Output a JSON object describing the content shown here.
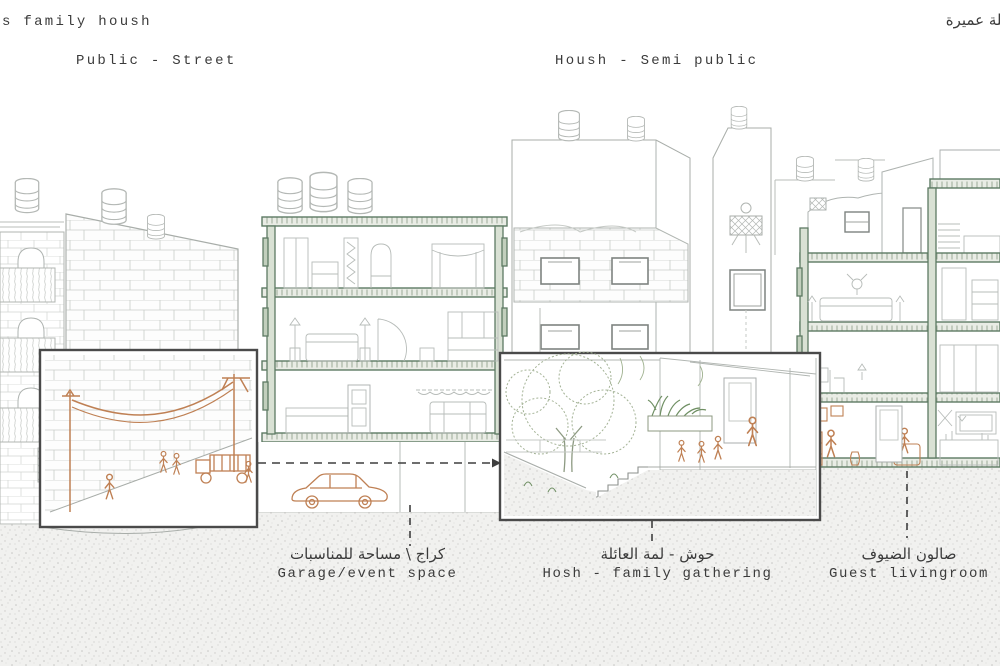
{
  "header": {
    "title_left": "s family housh",
    "title_right_ar": "نلة عميرة"
  },
  "zones": {
    "public_street": "Public - Street",
    "housh_semi_public": "Housh - Semi public"
  },
  "captions": {
    "garage": {
      "ar": "كراج \\ مساحة للمناسبات",
      "en": "Garage/event space"
    },
    "hosh": {
      "ar": "حوش - لمة العائلة",
      "en": "Hosh - family gathering"
    },
    "guest": {
      "ar": "صالون الضيوف",
      "en": "Guest livingroom"
    }
  },
  "colors": {
    "section_green": "#5d7a63",
    "accent_sienna": "#bf8054",
    "line_gray": "#b7bcb9",
    "stone_gray": "#cdd1cd",
    "vegetation_green": "#86a077",
    "ground_dot": "#c6c6c4",
    "frame_dark": "#4a4a4a",
    "text": "#3b3b3b"
  }
}
